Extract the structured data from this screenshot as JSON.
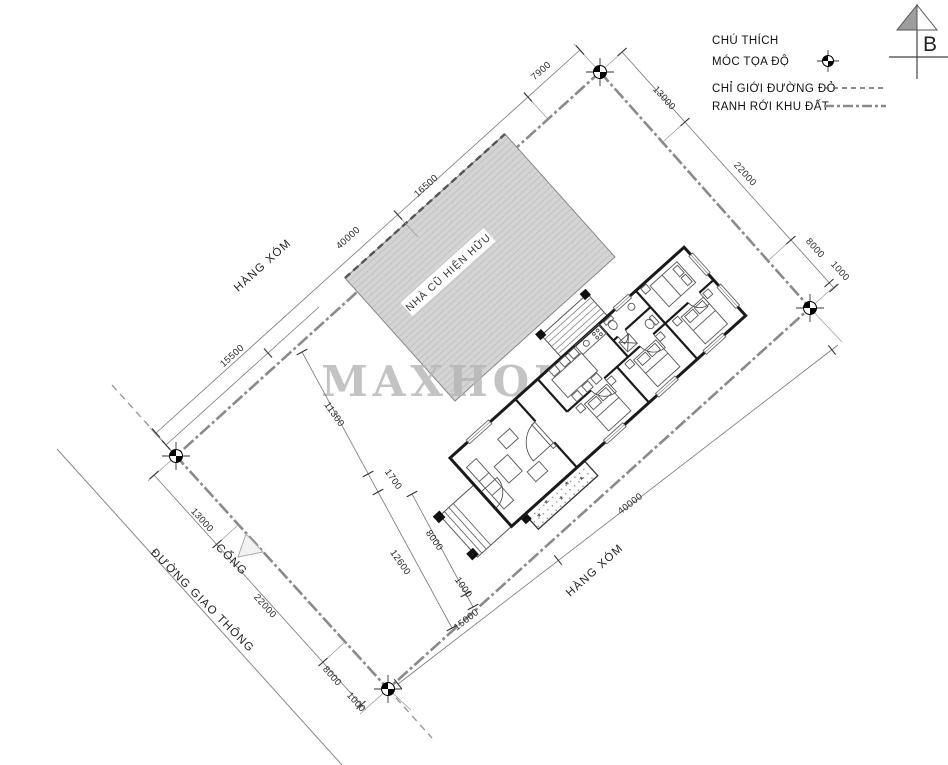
{
  "legend": {
    "title": "CHÚ THÍCH",
    "items": [
      {
        "label": "MÓC TỌA ĐỘ",
        "symbol": "survey-marker"
      },
      {
        "label": "CHỈ GIỚI ĐƯỜNG ĐỎ",
        "symbol": "dashed-line"
      },
      {
        "label": "RANH RỚI KHU ĐẤT",
        "symbol": "dash-dot-line"
      }
    ]
  },
  "north_arrow": {
    "label": "B"
  },
  "watermark": {
    "text": "MAXHOME"
  },
  "site_labels": {
    "existing_house": "NHÀ CŨ HIỆN HỮU",
    "neighbor_top": "HÀNG XÓM",
    "neighbor_bottom": "HÀNG XÓM",
    "gate": "CỔNG",
    "road": "ĐƯỜNG GIAO THÔNG"
  },
  "dimensions": {
    "top_left_edge": [
      "40000",
      "16500",
      "7900"
    ],
    "top_left_inner": [
      "15500"
    ],
    "top_right_edge": [
      "13000",
      "22000",
      "8000",
      "1000"
    ],
    "bottom_left_edge": [
      "13000",
      "22000",
      "8000",
      "1000"
    ],
    "bottom_right_edge": [
      "15000",
      "40000"
    ],
    "cross_chain": [
      "11300",
      "1700",
      "12600"
    ],
    "entry_chain": [
      "8000",
      "1000"
    ],
    "porch_width": "3000"
  },
  "colors": {
    "boundary": "#8a8a8a",
    "dimension_line": "#777777",
    "wall": "#1a1a1a",
    "existing_house_fill": "#d4d4d4",
    "watermark": "#b5b5b5"
  }
}
